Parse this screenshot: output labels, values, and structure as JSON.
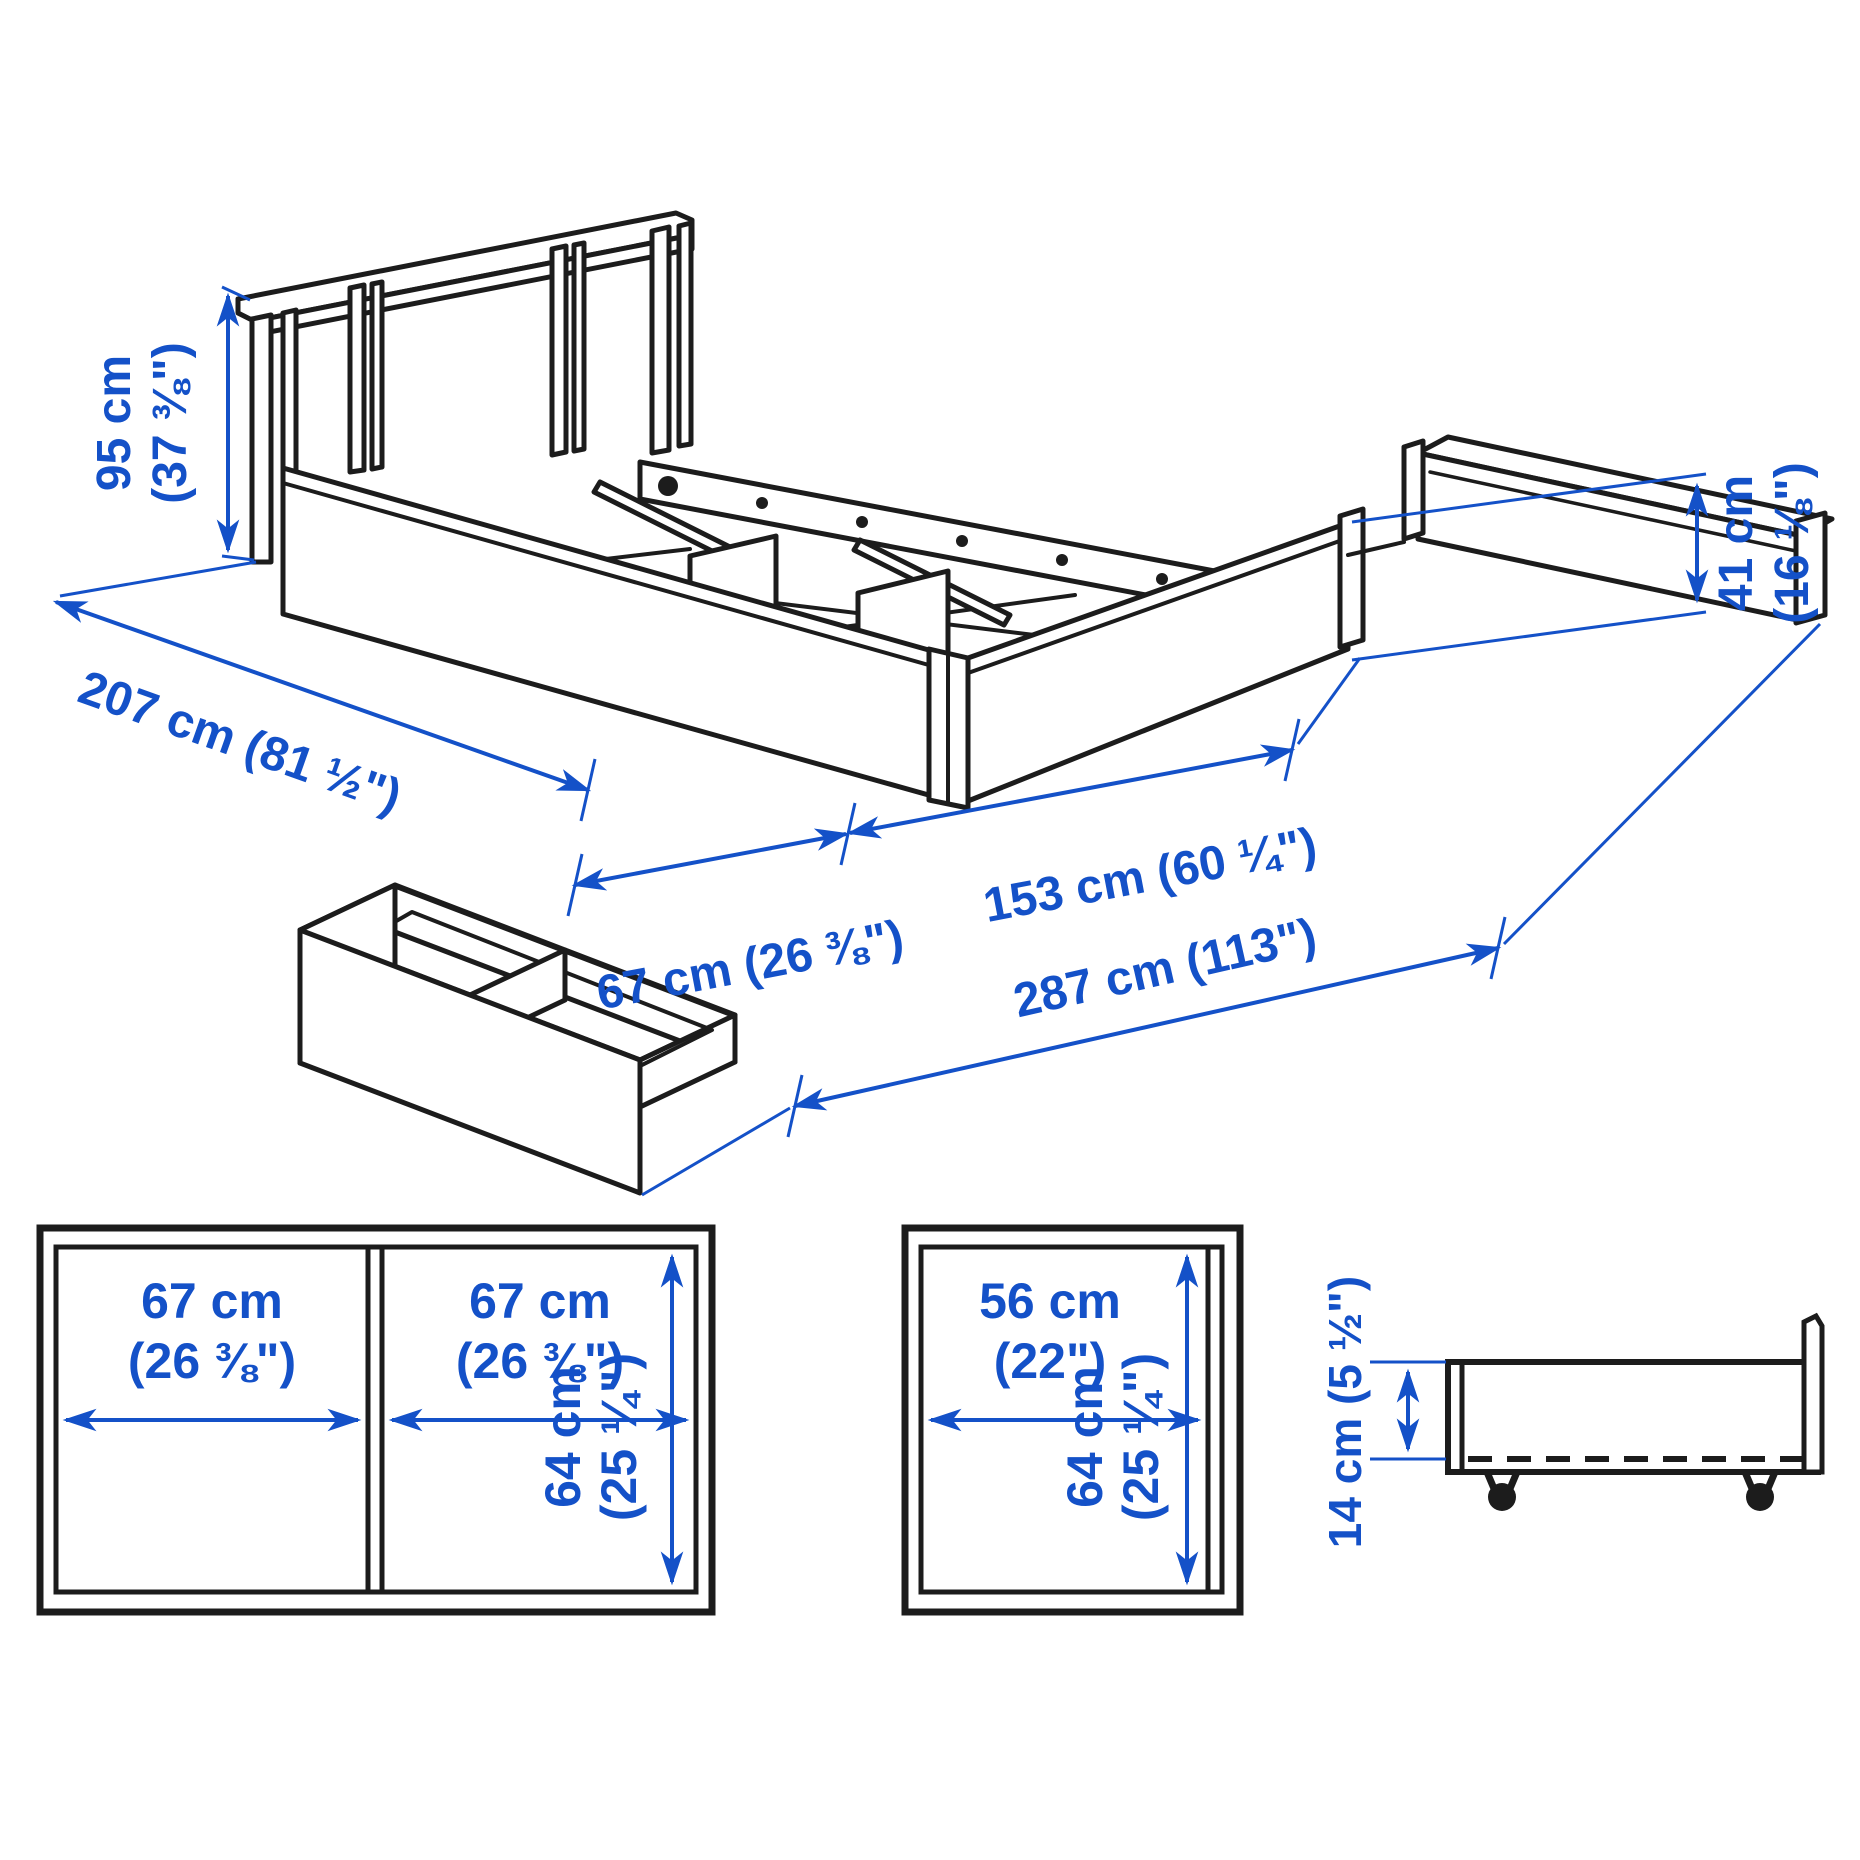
{
  "diagram": {
    "background": "#ffffff",
    "line_color": "#1c1c1c",
    "accent_blue": "#1451C8",
    "subject": "bed frame with under-bed storage boxes, dimension drawing"
  },
  "iso": {
    "headboard_height": {
      "value": "95 cm",
      "inches": "(37 ⅜\")"
    },
    "side_rail_height": {
      "value": "41 cm",
      "inches": "(16 ⅛\")"
    },
    "bed_length": "207 cm (81 ½\")",
    "drawer_extension": "67 cm (26 ⅜\")",
    "bed_width": "153 cm (60 ¼\")",
    "total_width": "287 cm (113\")"
  },
  "boxes": {
    "double": {
      "cell1": {
        "w": "67 cm",
        "w_in": "(26 ⅜\")"
      },
      "cell2": {
        "w": "67 cm",
        "w_in": "(26 ⅜\")"
      },
      "h": "64 cm",
      "h_in": "(25 ¼\")"
    },
    "single": {
      "w": "56 cm",
      "w_in": "(22\")",
      "h": "64 cm",
      "h_in": "(25 ¼\")"
    },
    "side_profile": {
      "h": "14 cm (5 ½\")"
    }
  }
}
